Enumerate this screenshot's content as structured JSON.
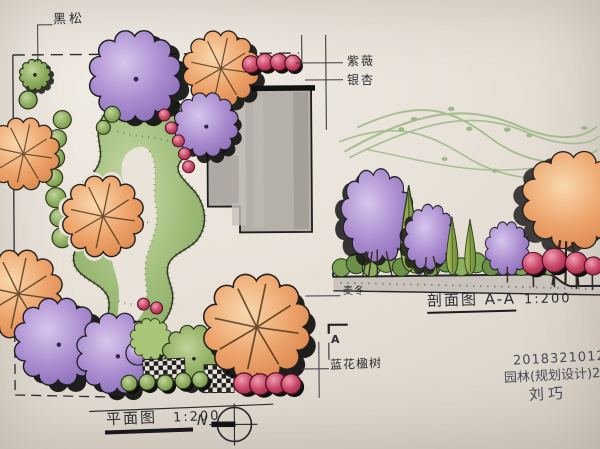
{
  "plan": {
    "title": "平面图",
    "scale": "1:200",
    "north_label": "N",
    "labels": {
      "black_pine": "黑松",
      "crape_myrtle": "紫薇",
      "ginkgo": "银杏",
      "jacaranda": "蓝花楹树",
      "section_marker": "A"
    }
  },
  "section": {
    "title": "剖面图 A-A",
    "scale": "1:200",
    "labels": {
      "liriope": "麦冬"
    }
  },
  "title_block": {
    "student_id": "20183210128",
    "course_line": "园林(规划设计)2018",
    "author": "刘巧"
  },
  "colors": {
    "paper": "#e8e2d9",
    "ink": "#1c1c1c",
    "purple_tree": "#a98ccd",
    "orange_tree": "#eca36b",
    "lawn_green": "#9ab873",
    "dark_green": "#7ca253",
    "red_shrub": "#c63f62",
    "building_gray": "#b7b1ab",
    "swirl_green": "#a4bd8f",
    "handwriting": "#454a58"
  }
}
